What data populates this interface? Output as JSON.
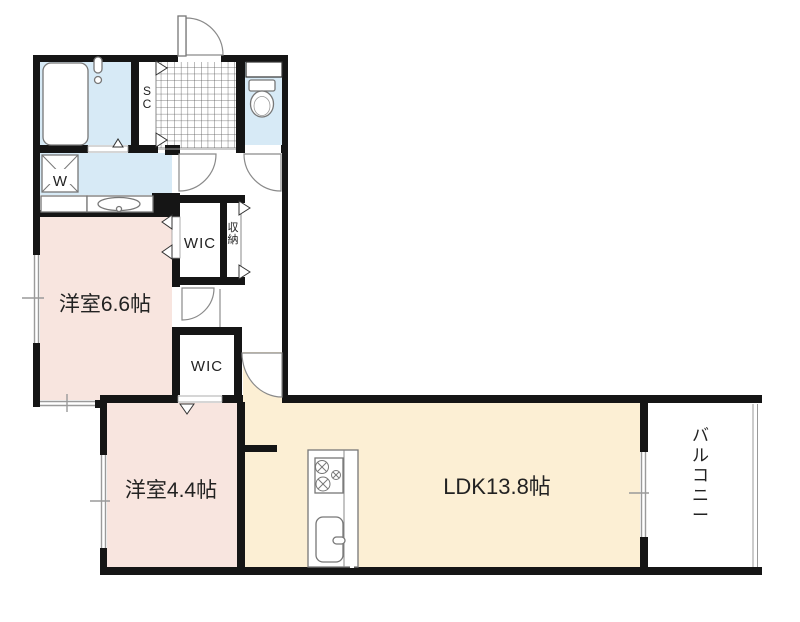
{
  "plan": {
    "title": "1LDK-floor-plan",
    "rooms": {
      "bedroom1_label": "洋室6.6帖",
      "bedroom2_label": "洋室4.4帖",
      "ldk_label": "LDK13.8帖",
      "balcony_label": "バルコニー",
      "wic1_label": "WIC",
      "wic2_label": "WIC",
      "storage_label": "収納",
      "shoe_closet_label": "SC",
      "washer_label": "W"
    },
    "colors": {
      "bedroom_floor": "#f8e5df",
      "ldk_floor": "#fcefd4",
      "wet_area_floor": "#d7eaf6",
      "wall": "#151515",
      "outline_gray": "#8a8a8a"
    }
  }
}
